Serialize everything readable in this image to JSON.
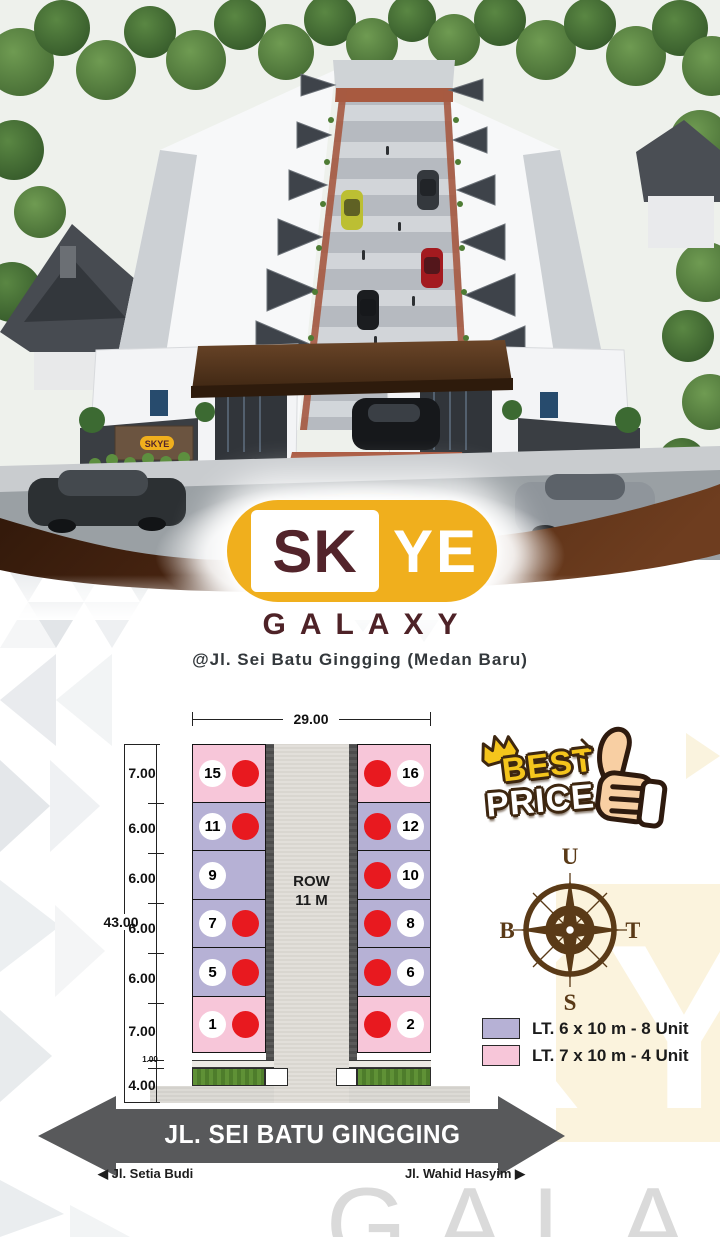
{
  "brand": {
    "name_left": "SK",
    "name_right": "YE",
    "line2": "GALAXY",
    "address": "@Jl. Sei Batu Gingging (Medan Baru)",
    "gate_sign": "SKYE"
  },
  "site_plan": {
    "total_width": "29.00",
    "total_height": "43.00",
    "road_label": [
      "ROW",
      "11 M"
    ],
    "front_setback": "1.00",
    "front_road": "4.00",
    "rows": [
      {
        "dim": "7.00",
        "type": "pink",
        "left": {
          "n": "15",
          "sold": true
        },
        "right": {
          "n": "16",
          "sold": true
        }
      },
      {
        "dim": "6.00",
        "type": "lav",
        "left": {
          "n": "11",
          "sold": true
        },
        "right": {
          "n": "12",
          "sold": true
        }
      },
      {
        "dim": "6.00",
        "type": "lav",
        "left": {
          "n": "9",
          "sold": false
        },
        "right": {
          "n": "10",
          "sold": true
        }
      },
      {
        "dim": "6.00",
        "type": "lav",
        "left": {
          "n": "7",
          "sold": true
        },
        "right": {
          "n": "8",
          "sold": true
        }
      },
      {
        "dim": "6.00",
        "type": "lav",
        "left": {
          "n": "5",
          "sold": true
        },
        "right": {
          "n": "6",
          "sold": true
        }
      },
      {
        "dim": "7.00",
        "type": "pink",
        "left": {
          "n": "1",
          "sold": true
        },
        "right": {
          "n": "2",
          "sold": true
        }
      }
    ]
  },
  "badge": {
    "top": "BEST",
    "bottom": "PRICE"
  },
  "compass": {
    "n": "U",
    "e": "T",
    "s": "S",
    "w": "B"
  },
  "legend": [
    {
      "swatch": "#B6B1D5",
      "label": "LT. 6 x 10 m - 8 Unit"
    },
    {
      "swatch": "#F7C6D9",
      "label": "LT. 7 x 10 m - 4 Unit"
    }
  ],
  "street_banner": "JL. SEI BATU GINGGING",
  "cross_streets": {
    "left": "Jl. Setia Budi",
    "right": "Jl. Wahid Hasyim"
  },
  "watermark": {
    "right": "KY",
    "bottom": "GALA"
  },
  "colors": {
    "logo_yellow": "#F0AF1D",
    "logo_maroon": "#4E2227",
    "band_brown": "#4A2410",
    "lot_lavender": "#B6B1D5",
    "lot_pink": "#F7C6D9",
    "sold_red": "#E8191F",
    "arrow_gray": "#58595B",
    "compass_brown": "#5A3A17",
    "cream": "#FBF3DD"
  }
}
